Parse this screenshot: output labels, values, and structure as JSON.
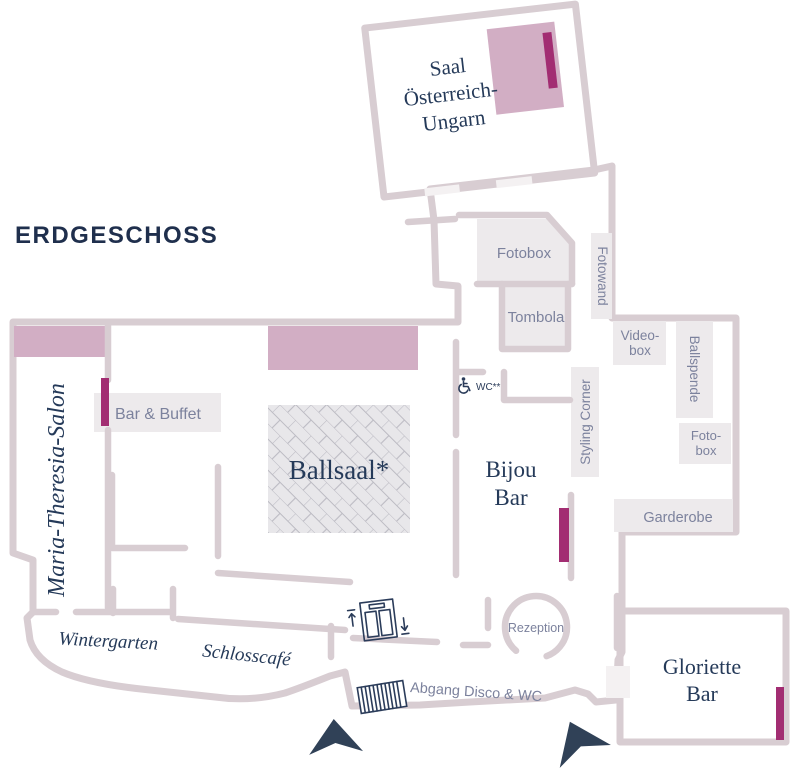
{
  "title": "ERDGESCHOSS",
  "rooms": {
    "saal_oesterreich_ungarn": {
      "line1": "Saal",
      "line2": "Österreich-",
      "line3": "Ungarn"
    },
    "ballsaal": {
      "label": "Ballsaal*"
    },
    "bijou_bar": {
      "line1": "Bijou",
      "line2": "Bar"
    },
    "gloriette_bar": {
      "line1": "Gloriette",
      "line2": "Bar"
    },
    "maria_theresia_salon": {
      "label": "Maria-Theresia-Salon"
    },
    "wintergarten": {
      "label": "Wintergarten"
    },
    "schlosscafe": {
      "label": "Schlosscafé"
    }
  },
  "areas": {
    "fotobox": "Fotobox",
    "tombola": "Tombola",
    "fotowand": "Fotowand",
    "videobox": {
      "line1": "Video-",
      "line2": "box"
    },
    "ballspende": "Ballspende",
    "fotobox_small": {
      "line1": "Foto-",
      "line2": "box"
    },
    "garderobe": "Garderobe",
    "styling_corner": "Styling Corner",
    "bar_buffet": "Bar & Buffet",
    "wc": "WC**",
    "rezeption": "Rezeption",
    "abgang_disco_wc": "Abgang Disco & WC"
  },
  "colors": {
    "wall": "#d8cdd2",
    "room_fill": "#f4f1f2",
    "area_fill": "#edeaec",
    "stage_pink": "#d2aec4",
    "door_magenta": "#a22d72",
    "label_navy": "#253a59",
    "label_gray_blue": "#7c829d",
    "arrow_navy": "#304157",
    "dancefloor_fill": "#e8e7ea",
    "dancefloor_line": "#bcbbc3"
  }
}
